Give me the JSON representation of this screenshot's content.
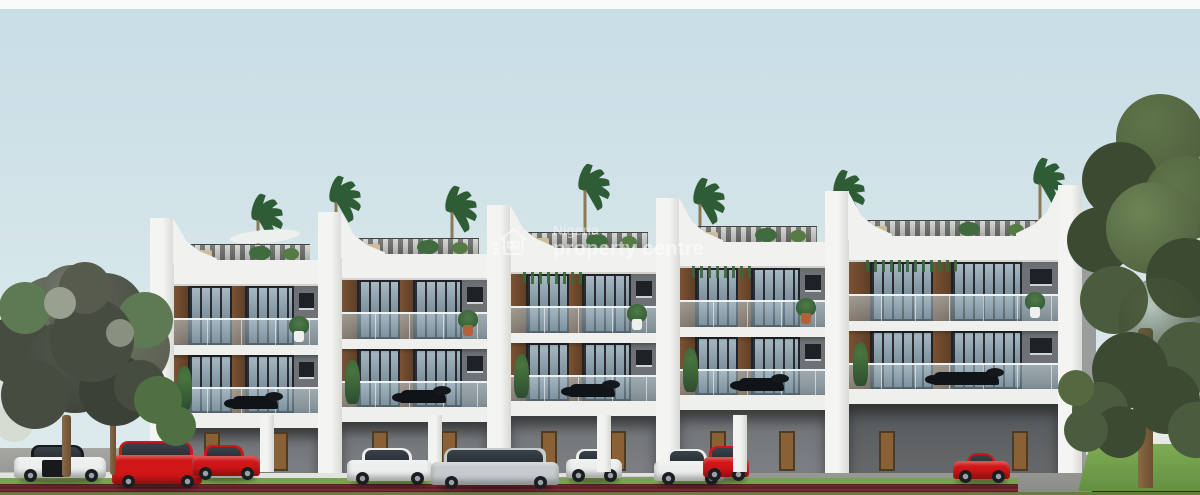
{
  "scene": {
    "type": "3d-architectural-rendering",
    "description": "Front elevation render of a row of five modern three-level terraced duplexes with rooftop pergola terraces, glass balustrade balconies, floor-to-ceiling windows and ground-floor carports; cars parked in front, large trees at both ends, road with red paver strip in foreground",
    "watermark": {
      "brand_line1": "Nigeria",
      "brand_line2": "property centre",
      "icon": "npc-house-logo"
    },
    "building": {
      "units": 5,
      "levels_visible": 3,
      "features": [
        "rooftop pergola terrace with plants",
        "curved white party-wall fins",
        "glass balustrades",
        "floor-to-ceiling windows with timber panels",
        "carport with brown doors"
      ]
    },
    "vehicles": [
      {
        "color_key": "twotone",
        "body": "sedan",
        "label": "black and white sedan"
      },
      {
        "color_key": "red",
        "body": "suv",
        "label": "red SUV"
      },
      {
        "color_key": "red",
        "body": "sedan",
        "label": "red sedan"
      },
      {
        "color_key": "white",
        "body": "sedan",
        "label": "white sedan"
      },
      {
        "color_key": "silver",
        "body": "estate",
        "label": "silver estate"
      },
      {
        "color_key": "white",
        "body": "sedan",
        "label": "white sedan"
      },
      {
        "color_key": "white",
        "body": "sedan",
        "label": "white sedan"
      },
      {
        "color_key": "red",
        "body": "hatch",
        "label": "red hatchback"
      },
      {
        "color_key": "red",
        "body": "coupe",
        "label": "red coupe"
      }
    ],
    "landscape": {
      "left_tree": "large dark-foliage tree",
      "far_left_tree": "pale tree",
      "right_tree": "large green tree",
      "roof_plants": "palm trees and shrubs",
      "foreground": "green verge and red paver road"
    },
    "palette": {
      "sky_top": "#c8dde5",
      "sky_mid": "#d3e4e9",
      "sky_bottom": "#dfecee",
      "facade": "#6e7275",
      "wood": "#7b5233",
      "door": "#8a6134",
      "grass": "#7ba34f",
      "road_stripe": "#6e2430",
      "palm": "#2e5c35",
      "car_red": "#d01616",
      "car_white": "#edefee",
      "car_silver": "#c6cbcd",
      "tree_dark": "#474c41",
      "tree_green": "#4b5b3d"
    }
  }
}
